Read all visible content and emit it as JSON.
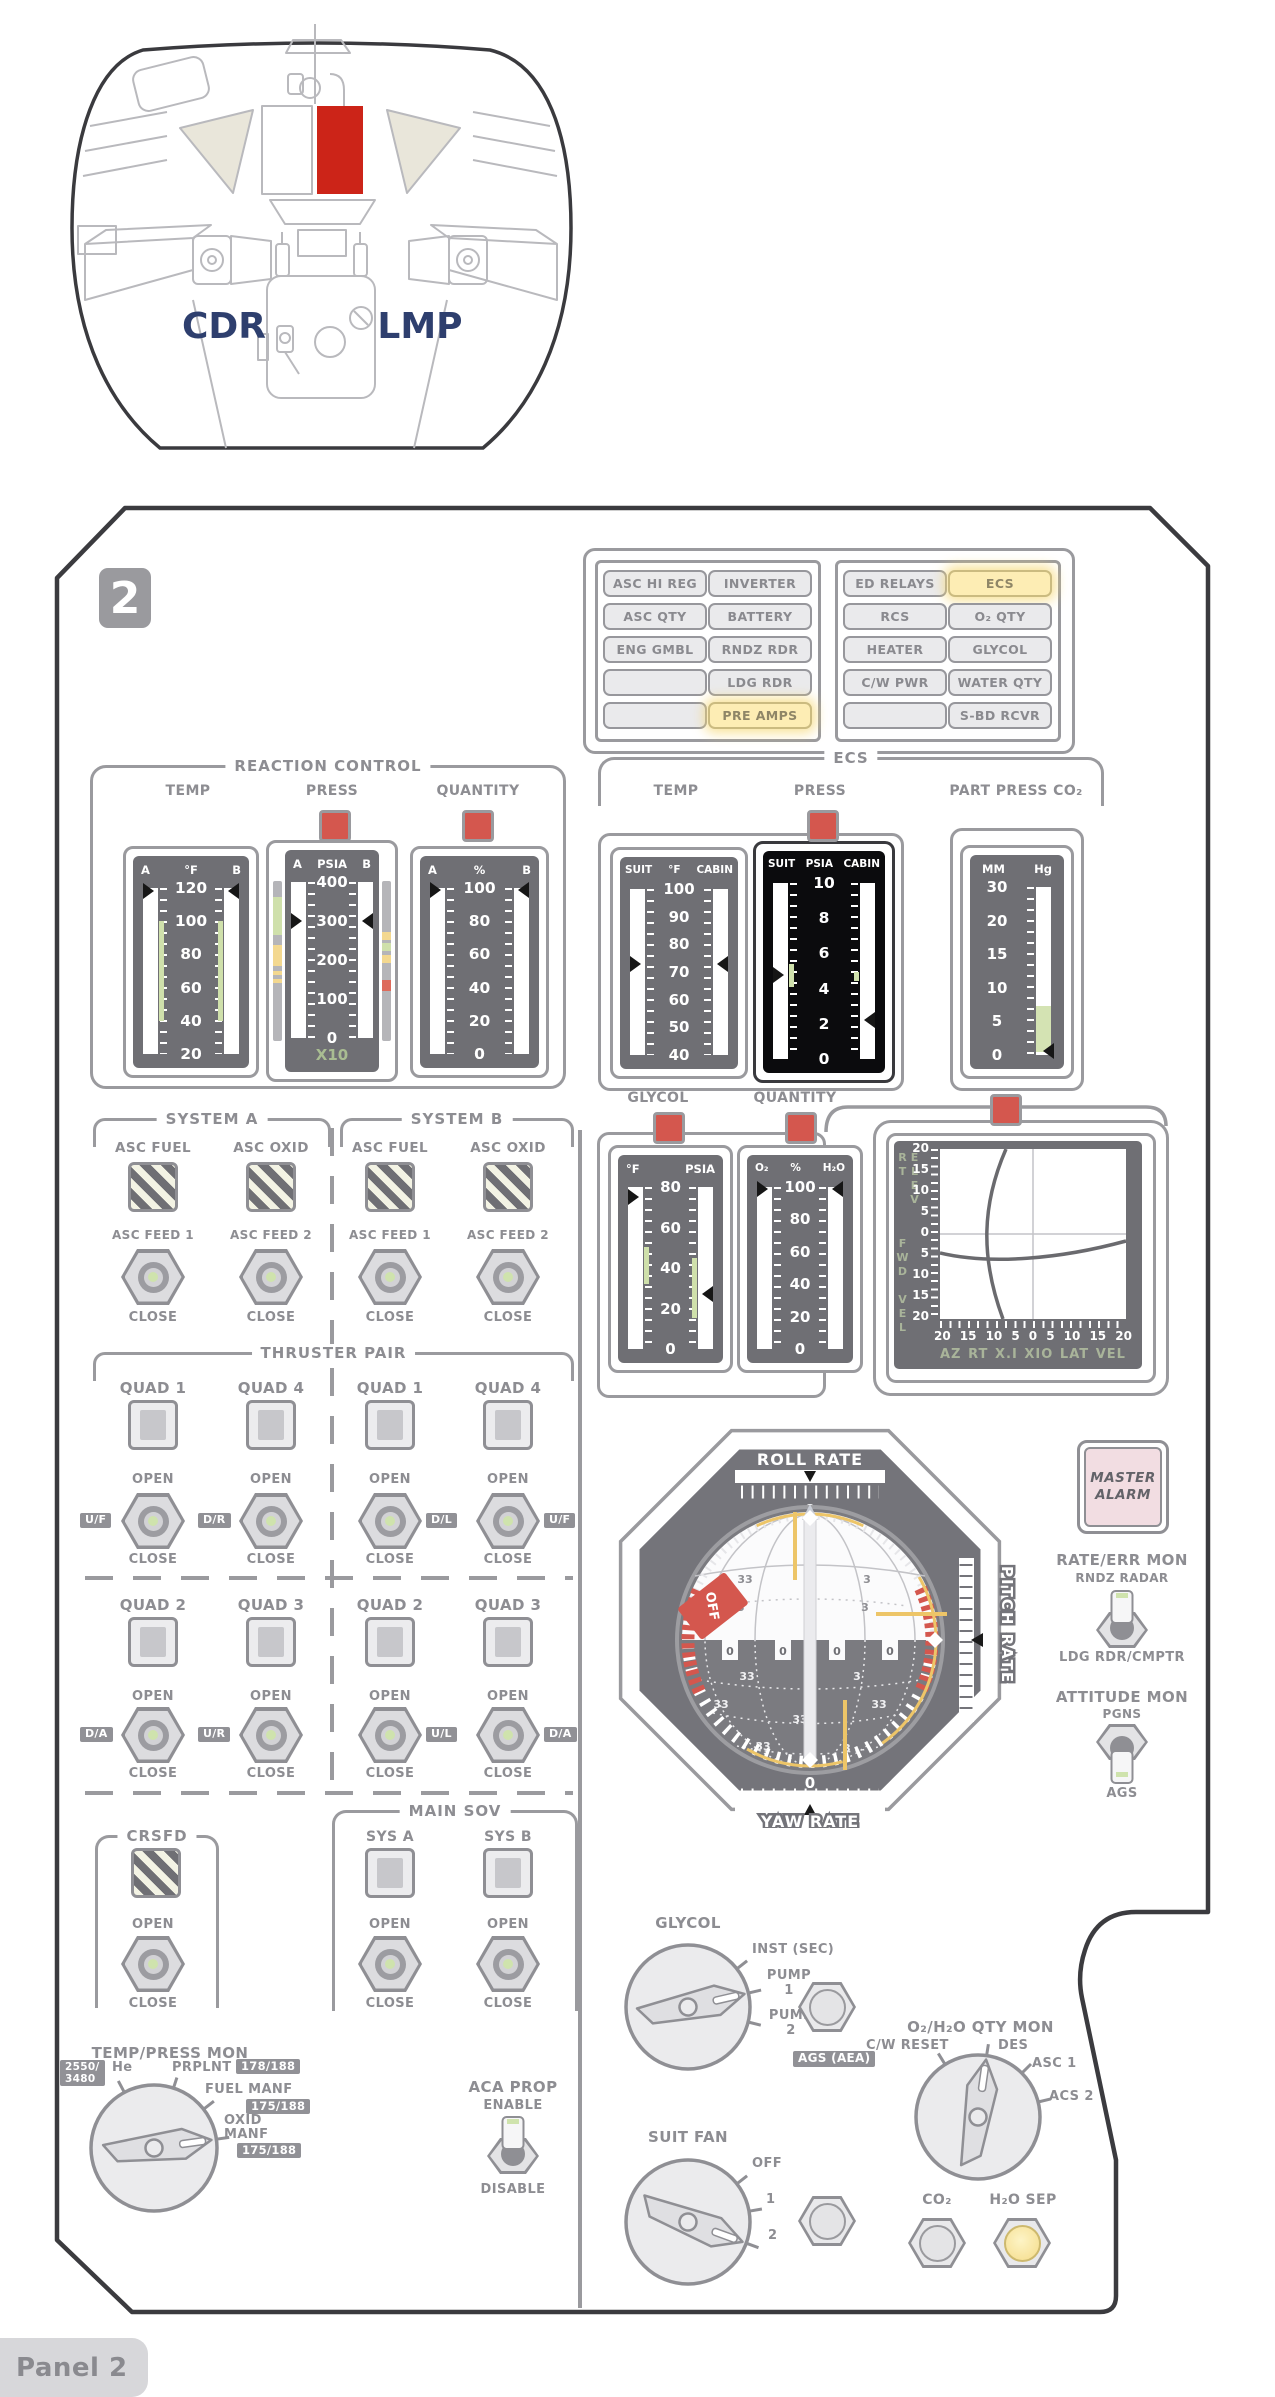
{
  "cabin": {
    "cdr": "CDR",
    "lmp": "LMP"
  },
  "panel": {
    "number": "2",
    "footer": "Panel 2"
  },
  "cw": {
    "left": [
      [
        "ASC HI REG",
        "INVERTER"
      ],
      [
        "ASC QTY",
        "BATTERY"
      ],
      [
        "ENG GMBL",
        "RNDZ RDR"
      ],
      [
        "",
        "LDG RDR"
      ],
      [
        "",
        "PRE AMPS"
      ]
    ],
    "right": [
      [
        "ED RELAYS",
        "ECS"
      ],
      [
        "RCS",
        "O₂ QTY"
      ],
      [
        "HEATER",
        "GLYCOL"
      ],
      [
        "C/W PWR",
        "WATER QTY"
      ],
      [
        "",
        "S-BD RCVR"
      ]
    ]
  },
  "rcs": {
    "title": "REACTION CONTROL",
    "temp": {
      "label": "TEMP",
      "l": "A",
      "u": "°F",
      "r": "B",
      "ticks": [
        "120",
        "100",
        "80",
        "60",
        "40",
        "20"
      ]
    },
    "press": {
      "label": "PRESS",
      "l": "A",
      "u": "PSIA",
      "r": "B",
      "ticks": [
        "400",
        "300",
        "200",
        "100",
        "0"
      ],
      "mult": "X10"
    },
    "qty": {
      "label": "QUANTITY",
      "l": "A",
      "u": "%",
      "r": "B",
      "ticks": [
        "100",
        "80",
        "60",
        "40",
        "20",
        "0"
      ]
    }
  },
  "ecs": {
    "title": "ECS",
    "temp": {
      "label": "TEMP",
      "l": "SUIT",
      "u": "°F",
      "r": "CABIN",
      "ticks": [
        "100",
        "90",
        "80",
        "70",
        "60",
        "50",
        "40"
      ]
    },
    "press": {
      "label": "PRESS",
      "l": "SUIT",
      "u": "PSIA",
      "r": "CABIN",
      "ticks": [
        "10",
        "8",
        "6",
        "4",
        "2",
        "0"
      ]
    },
    "co2": {
      "label": "PART PRESS CO₂",
      "l": "MM",
      "r": "Hg",
      "ticks": [
        "30",
        "20",
        "15",
        "10",
        "5",
        "0"
      ]
    },
    "glycol": {
      "label": "GLYCOL",
      "l": "°F",
      "r": "PSIA",
      "ticks": [
        "80",
        "60",
        "40",
        "20",
        "0"
      ]
    },
    "qty": {
      "label": "QUANTITY",
      "l": "O₂",
      "u": "%",
      "r": "H₂O",
      "ticks": [
        "100",
        "80",
        "60",
        "40",
        "20",
        "0"
      ]
    }
  },
  "xptr": {
    "left_top": "ELEV RT",
    "left_bottom": "FWD VEL",
    "v": [
      "20",
      "15",
      "10",
      "5",
      "0",
      "5",
      "10",
      "15",
      "20"
    ],
    "h": [
      "20",
      "15",
      "10",
      "5",
      "0",
      "5",
      "10",
      "15",
      "20"
    ],
    "bottom": [
      "AZ",
      "RT",
      "X.I",
      "XIO",
      "LAT",
      "VEL"
    ]
  },
  "fdai": {
    "roll": "ROLL RATE",
    "yaw": "YAW RATE",
    "pitch": "PITCH RATE",
    "zero": "0",
    "off": "OFF",
    "sphere": [
      "33",
      "3",
      "33",
      "3",
      "33",
      "3",
      "33",
      "33",
      "33",
      "33",
      "3"
    ]
  },
  "valves": {
    "sysa": "SYSTEM A",
    "sysb": "SYSTEM B",
    "open": "OPEN",
    "close": "CLOSE",
    "asc_fuel": "ASC FUEL",
    "asc_oxid": "ASC OXID",
    "feed1": "ASC FEED 1",
    "feed2": "ASC FEED 2",
    "thruster": "THRUSTER PAIR",
    "quads": [
      "QUAD 1",
      "QUAD 4",
      "QUAD 1",
      "QUAD 4",
      "QUAD 2",
      "QUAD 3",
      "QUAD 2",
      "QUAD 3"
    ],
    "tags": [
      "U/F",
      "D/R",
      "D/L",
      "U/F",
      "D/A",
      "U/R",
      "U/L",
      "D/A"
    ],
    "crsfd": "CRSFD",
    "mainsov": "MAIN SOV",
    "sa": "SYS A",
    "sb": "SYS B"
  },
  "tpmon": {
    "title": "TEMP/PRESS MON",
    "badge1a": "2550/",
    "badge1b": "3480",
    "he": "He",
    "prplnt": "PRPLNT",
    "b178": "178/188",
    "fuel": "FUEL MANF",
    "b175a": "175/188",
    "oxid1": "OXID",
    "oxid2": "MANF",
    "b175b": "175/188"
  },
  "aca": {
    "title": "ACA PROP",
    "enable": "ENABLE",
    "disable": "DISABLE"
  },
  "alarm": {
    "l1": "MASTER",
    "l2": "ALARM"
  },
  "ratemon": {
    "title": "RATE/ERR MON",
    "up": "RNDZ RADAR",
    "down": "LDG RDR/CMPTR"
  },
  "attmon": {
    "title": "ATTITUDE MON",
    "up": "PGNS",
    "down": "AGS"
  },
  "glyknob": {
    "title": "GLYCOL",
    "p0": "INST (SEC)",
    "p1a": "PUMP",
    "p1b": "1",
    "p2a": "PUMP",
    "p2b": "2",
    "badge": "AGS (AEA)"
  },
  "fanknob": {
    "title": "SUIT FAN",
    "p0": "OFF",
    "p1": "1",
    "p2": "2"
  },
  "o2knob": {
    "title": "O₂/H₂O QTY MON",
    "p0": "C/W RESET",
    "p1": "DES",
    "p2": "ASC 1",
    "p3": "ACS 2"
  },
  "buttons": {
    "co2": "CO₂",
    "h2osep": "H₂O SEP"
  }
}
